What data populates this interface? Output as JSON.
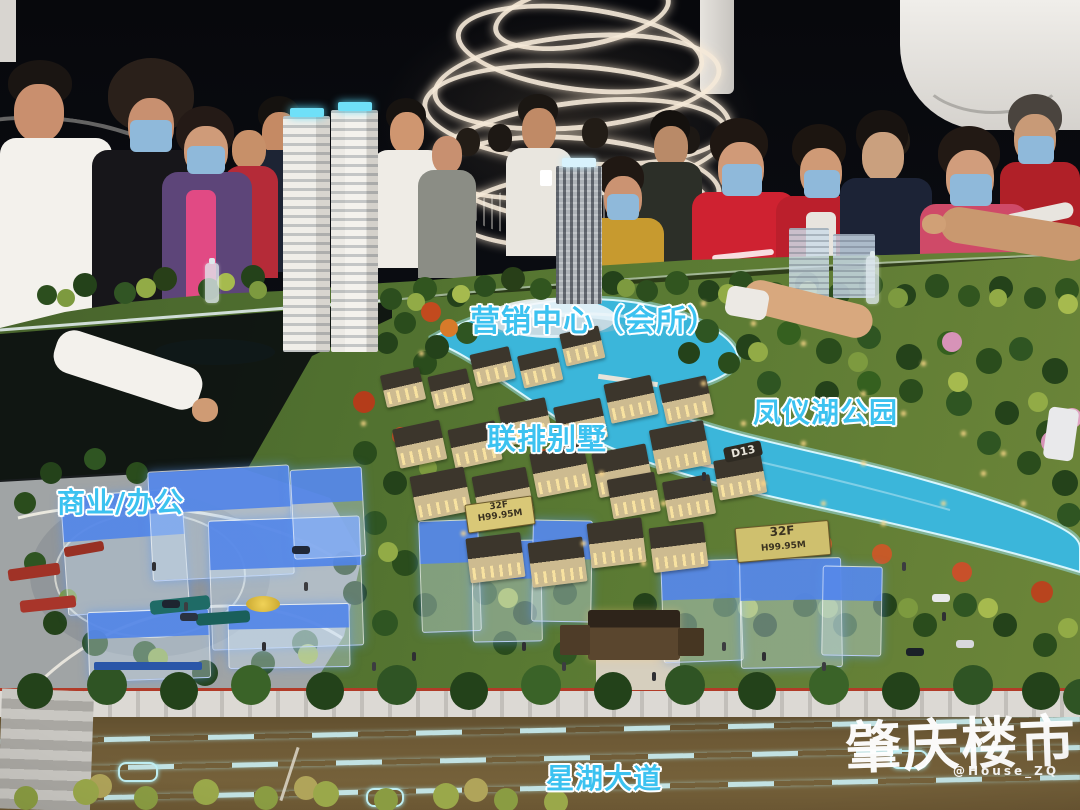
{
  "annotations": {
    "marketing_center": "营销中心（会所）",
    "lake_park": "凤仪湖公园",
    "townhouses": "联排别墅",
    "commercial_office": "商业/办公",
    "avenue": "星湖大道"
  },
  "model_signs": {
    "tower_sign_left": {
      "floors": "32F",
      "height": "H99.95M"
    },
    "tower_sign_right": {
      "floors": "32F",
      "height": "H99.95M"
    },
    "villa_block_label": "D13"
  },
  "watermark": {
    "logo": "肇庆楼市",
    "handle": "@House_ZQ"
  },
  "colors": {
    "annotation": "#3cc2f0",
    "annotation_outline": "#ffffff",
    "lake": "#35b5d8",
    "roof_glow": "#5a8ae8",
    "watermark": "#ffffff"
  }
}
